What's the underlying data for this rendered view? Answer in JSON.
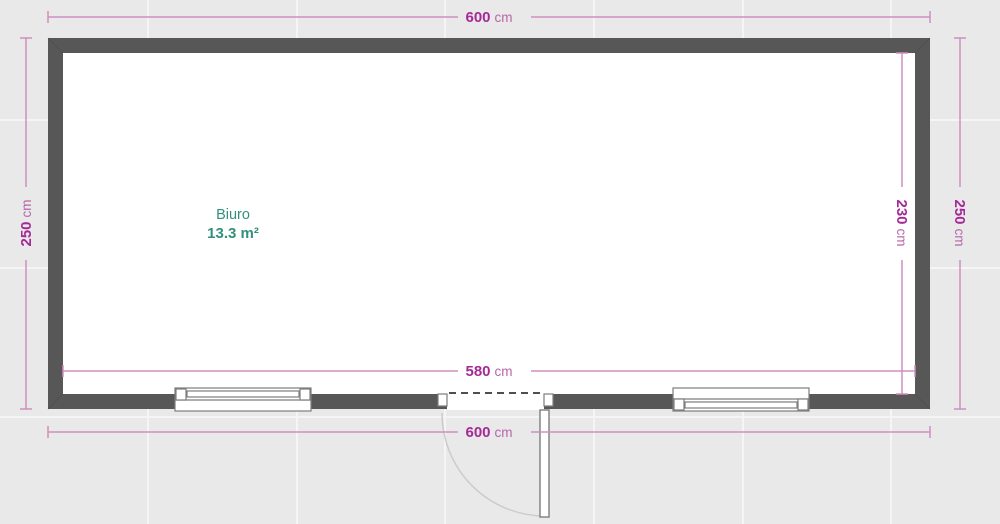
{
  "plan": {
    "room": {
      "name": "Biuro",
      "area": "13.3 m²"
    },
    "dimensions": {
      "top": {
        "value": "600",
        "unit": "cm"
      },
      "left": {
        "value": "250",
        "unit": "cm"
      },
      "right_inner": {
        "value": "230",
        "unit": "cm"
      },
      "right_outer": {
        "value": "250",
        "unit": "cm"
      },
      "bottom_inner": {
        "value": "580",
        "unit": "cm"
      },
      "bottom_outer": {
        "value": "600",
        "unit": "cm"
      }
    },
    "colors": {
      "background": "#e9e9e9",
      "grid_line": "#f5f5f5",
      "wall": "#575757",
      "wall_miter": "#4a4a4a",
      "floor": "#ffffff",
      "dimension_line": "#cf8fc0",
      "dimension_number": "#a52a96",
      "dimension_unit": "#b766a8",
      "room_label": "#33907c",
      "fixture_outline": "#7d7d7d",
      "door_dash": "#4f4f4f",
      "swing_arc": "#cccccc"
    }
  }
}
